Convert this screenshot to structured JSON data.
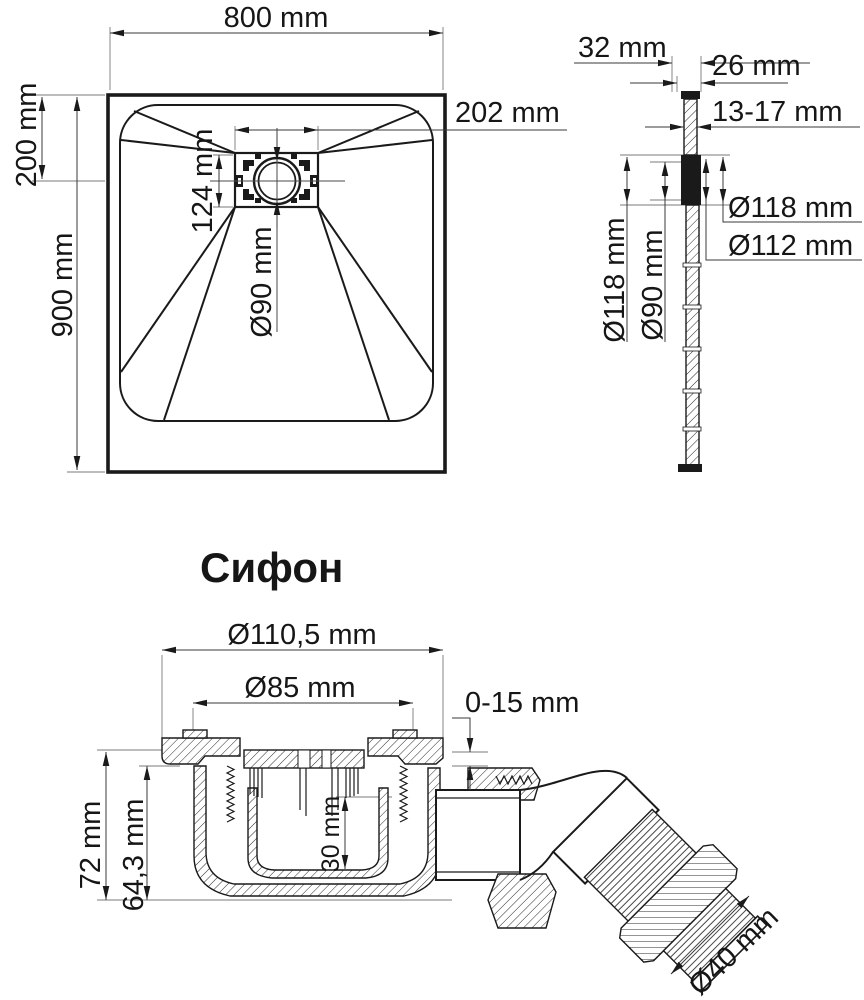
{
  "page": {
    "background": "#ffffff",
    "line_color": "#1a1a1a",
    "accent_color": "#2b3a5f"
  },
  "tray_top_view": {
    "width": "800 mm",
    "length": "900 mm",
    "drain_center_from_top": "200 mm",
    "drain_plate_width": "202 mm",
    "drain_plate_depth": "124 mm",
    "drain_hole_diameter": "Ø90 mm"
  },
  "tray_side_view": {
    "edge_height": "32 mm",
    "min_height": "26 mm",
    "bottom_thickness": "13-17 mm",
    "flange_outer_diameter": "Ø118 mm",
    "flange_recess_diameter": "Ø112 mm",
    "flange_outer_diameter_left": "Ø118 mm",
    "drain_hole_diameter": "Ø90 mm"
  },
  "siphon": {
    "title": "Сифон",
    "body_outer_diameter": "Ø110,5 mm",
    "body_inner_diameter": "Ø85 mm",
    "adjustment_range": "0-15 mm",
    "total_height": "72 mm",
    "body_height": "64,3 mm",
    "water_seal_height": "30 mm",
    "outlet_diameter": "Ø40 mm"
  }
}
